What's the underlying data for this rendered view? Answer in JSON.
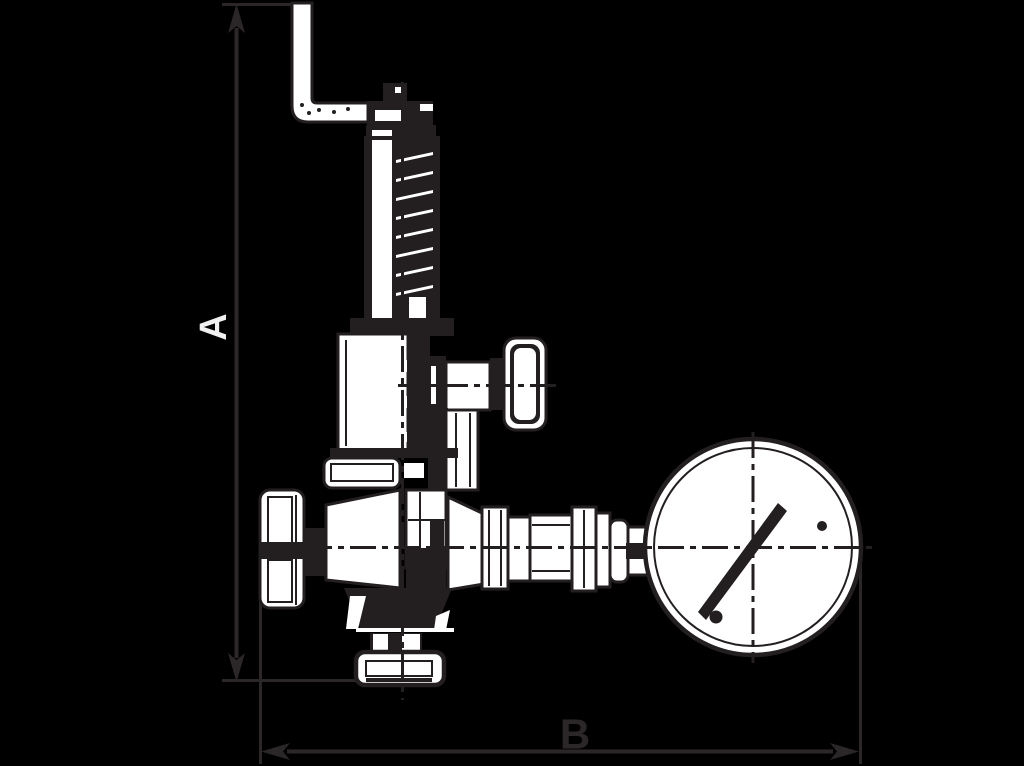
{
  "figure": {
    "type": "technical-drawing",
    "subject": "Safety relief valve with top test bracket, side hand knobs, bottom outlet flange and pressure gauge, side elevation with overall dimensions",
    "background_style": "black / transparent background, dark line art with white part faces"
  },
  "dimensions": {
    "vertical": {
      "label": "A",
      "orientation": "rotated-90-ccw"
    },
    "horizontal": {
      "label": "B",
      "orientation": "upright"
    }
  },
  "colors": {
    "background": "#000000",
    "line": "#231f20",
    "fill": "#ffffff",
    "dimension": "#2b2728",
    "label_a": "#f0f0f0",
    "label_b": "#2b2728"
  }
}
